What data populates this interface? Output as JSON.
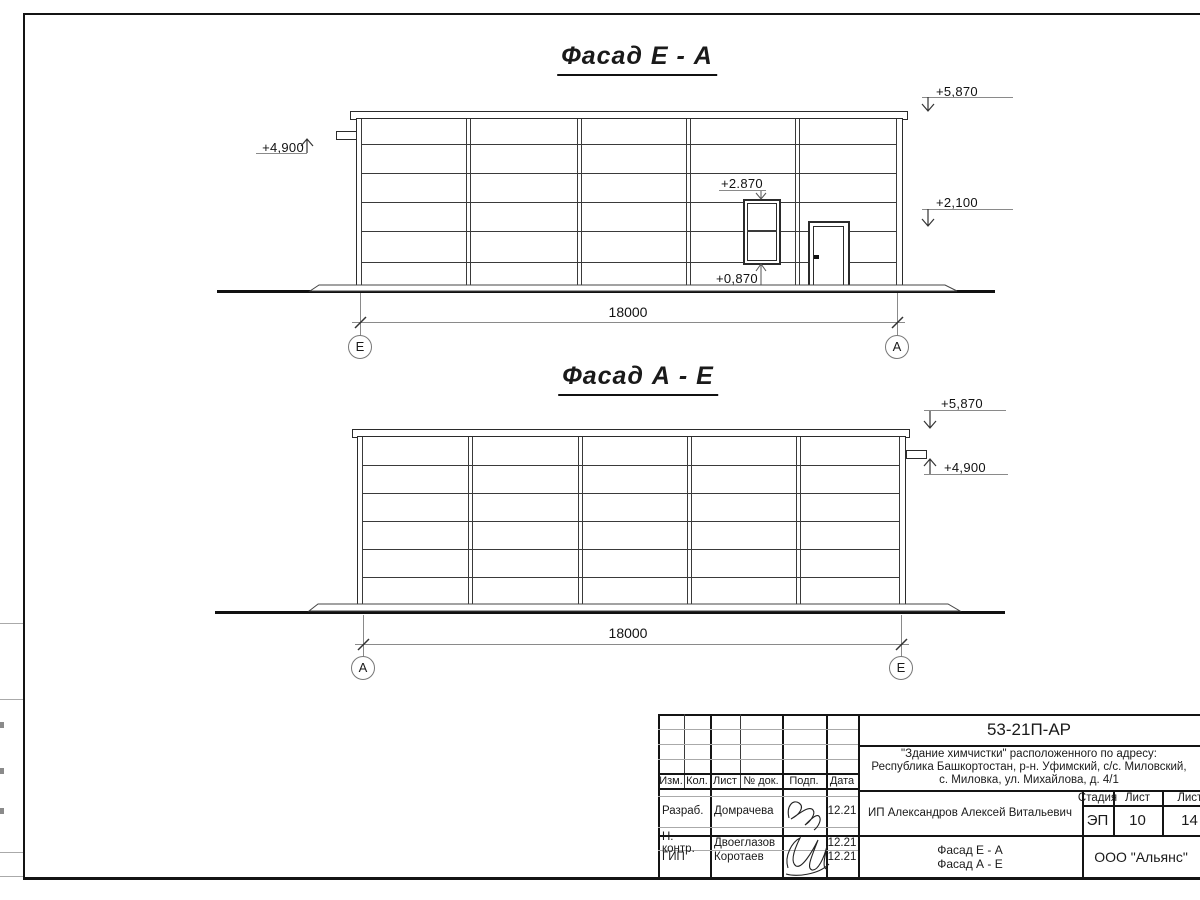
{
  "colors": {
    "ink": "#1a1a1a",
    "paper": "#ffffff"
  },
  "facade1": {
    "title": "Фасад Е - А",
    "dim": "18000",
    "axis_left": "Е",
    "axis_right": "А",
    "marks": {
      "m4900": "+4,900",
      "m5870": "+5,870",
      "m2870": "+2.870",
      "m2100": "+2,100",
      "m0870": "+0,870"
    }
  },
  "facade2": {
    "title": "Фасад А - Е",
    "dim": "18000",
    "axis_left": "А",
    "axis_right": "Е",
    "marks": {
      "m5870": "+5,870",
      "m4900": "+4,900"
    }
  },
  "stamp": {
    "doc_code": "53-21П-АР",
    "address_line1": "\"Здание химчистки\" расположенного по адресу:",
    "address_line2": "Республика Башкортостан, р-н. Уфимский, с/с. Миловский,",
    "address_line3": "с. Миловка, ул. Михайлова, д. 4/1",
    "cols": {
      "izm": "Изм.",
      "kol": "Кол.",
      "list": "Лист",
      "ndok": "№ док.",
      "podp": "Подп.",
      "data": "Дата"
    },
    "rows": [
      {
        "role": "Разраб.",
        "name": "Домрачева",
        "date": "12.21"
      },
      {
        "role": "Н. контр.",
        "name": "Двоеглазов",
        "date": "12.21"
      },
      {
        "role": "ГИП",
        "name": "Коротаев",
        "date": "12.21"
      }
    ],
    "stage_label": "Стадия",
    "sheet_label": "Лист",
    "sheets_label": "Листов",
    "stage": "ЭП",
    "sheet_no": "10",
    "sheets_total": "14",
    "client": "ИП Александров Алексей Витальевич",
    "drawing_title_line1": "Фасад Е - А",
    "drawing_title_line2": "Фасад А - Е",
    "company": "ООО \"Альянс\""
  }
}
